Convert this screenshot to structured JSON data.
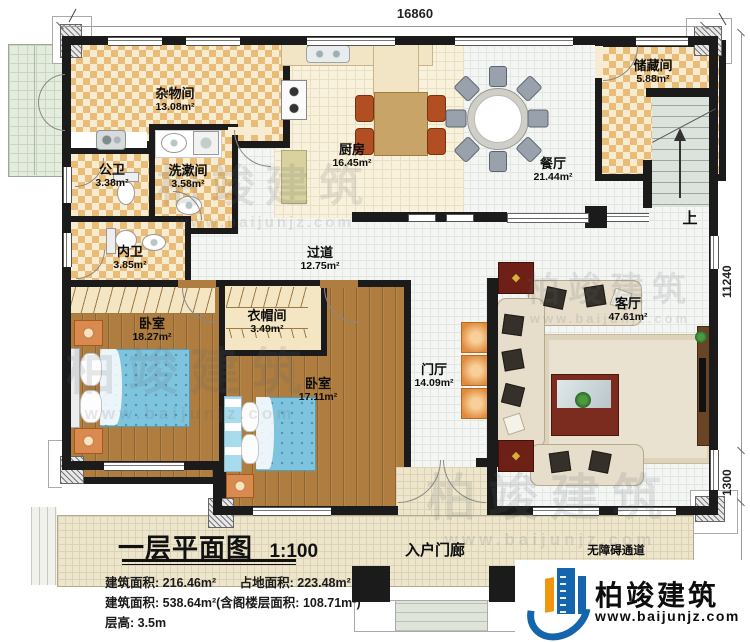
{
  "dimensions": {
    "top_width": "16860",
    "right_height": "11240",
    "right_porch_upper": "1300",
    "right_porch_lower": "2080"
  },
  "rooms": [
    {
      "name": "杂物间",
      "area": "13.08m²"
    },
    {
      "name": "公卫",
      "area": "3.38m²"
    },
    {
      "name": "洗漱间",
      "area": "3.58m²"
    },
    {
      "name": "内卫",
      "area": "3.85m²"
    },
    {
      "name": "厨房",
      "area": "16.45m²"
    },
    {
      "name": "餐厅",
      "area": "21.44m²"
    },
    {
      "name": "储藏间",
      "area": "5.88m²"
    },
    {
      "name": "过道",
      "area": "12.75m²"
    },
    {
      "name": "卧室",
      "area": "18.27m²"
    },
    {
      "name": "衣帽间",
      "area": "3.49m²"
    },
    {
      "name": "卧室",
      "area": "17.11m²"
    },
    {
      "name": "门厅",
      "area": "14.09m²"
    },
    {
      "name": "客厅",
      "area": "47.61m²"
    }
  ],
  "labels": {
    "stairs_up": "上",
    "entry_porch": "入户门廊",
    "accessible_ramp": "无障碍通道"
  },
  "title_block": {
    "title": "一层平面图",
    "scale": "1:100",
    "area_built": "建筑面积: 216.46m²",
    "area_footprint": "占地面积: 223.48m²",
    "area_line2": "建筑面积: 538.64m²(含阁楼层面积: 108.71m²)",
    "floor_height": "层高: 3.5m"
  },
  "logo": {
    "company": "柏竣建筑",
    "website": "www.baijunjz.com"
  },
  "watermark": {
    "text": "柏竣建筑",
    "subtext": "www.baijunjz.com"
  },
  "colors": {
    "wall": "#1b1b1b",
    "checker_tan": "#e9bd77",
    "wood": "#ae7d3f",
    "bed_blue": "#7fc4de",
    "logo_blue": "#1565ad",
    "logo_orange": "#f2960f"
  }
}
